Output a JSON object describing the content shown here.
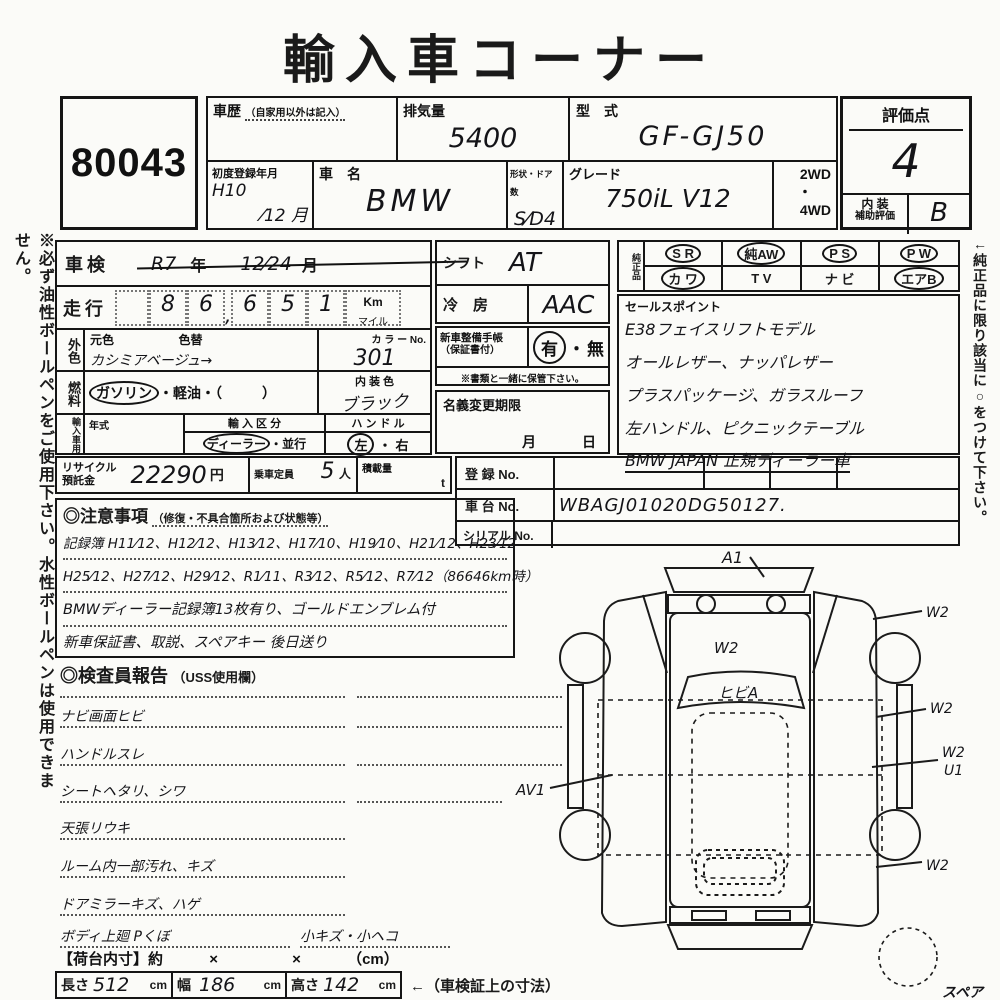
{
  "page": {
    "title": "輸入車コーナー"
  },
  "margins": {
    "left_note": "※必ず油性ボールペンをご使用下さい。水性ボールペンは使用できません。",
    "right_note": "←純正品に限り該当に○をつけて下さい。"
  },
  "lot": {
    "number": "80043"
  },
  "header": {
    "history_label": "車歴",
    "history_sub": "（自家用以外は記入）",
    "history_value": "",
    "displacement_label": "排気量",
    "displacement_value": "5400",
    "model_code_label": "型　式",
    "model_code_value": "GF-GJ50",
    "first_reg_label": "初度登録年月",
    "first_reg_top": "H10",
    "first_reg_bottom": "⁄12 月",
    "car_name_label": "車　名",
    "car_name_value": "BMW",
    "body_doors_label": "形状・ドア数",
    "body_doors_value": "S⁄D4",
    "grade_label": "グレード",
    "grade_value": "750iL  V12",
    "drive_top": "2WD",
    "drive_dot": "・",
    "drive_bottom": "4WD"
  },
  "score": {
    "label": "評価点",
    "value": "4",
    "interior_label_1": "内 装",
    "interior_label_2": "補助評価",
    "interior_value": "B"
  },
  "inspection_expiry": {
    "label": "車検",
    "era": "R7",
    "year_unit": "年",
    "date": "12⁄24",
    "month_unit": "月"
  },
  "mileage": {
    "label": "走行",
    "d1": "8",
    "d2": "6",
    "comma": ",",
    "d3": "6",
    "d4": "5",
    "d5": "1",
    "unit_top": "Km",
    "unit_bottom": "マイル"
  },
  "exterior": {
    "side_label": "外色",
    "base_label": "元色",
    "repaint_label": "色替",
    "value": "カシミアベージュ→",
    "color_no_label": "カ ラ ー No.",
    "color_no_value": "301"
  },
  "fuel": {
    "side_label": "燃料",
    "opt_gasoline": "ガソリン",
    "sep1": "・",
    "opt_diesel": "軽油",
    "sep2": "・（",
    "paren_close": "）",
    "interior_color_label": "内 装 色",
    "interior_color_value": "ブラック"
  },
  "import_use": {
    "side_label": "輸入車用",
    "year_label": "年式",
    "year_value": "",
    "route_label": "輸 入 区 分",
    "route_opt1": "ディーラー",
    "route_sep": "・",
    "route_opt2": "並行",
    "handle_label": "ハ ン ド ル",
    "handle_opt1": "左",
    "handle_sep": "・",
    "handle_opt2": "右"
  },
  "shift": {
    "label": "シフト",
    "value": "AT"
  },
  "ac": {
    "label": "冷　房",
    "value": "AAC"
  },
  "service_book": {
    "label_1": "新車整備手帳",
    "label_2": "（保証書付）",
    "yes": "有",
    "mid_dot": "・",
    "no": "無",
    "note": "※書類と一緒に保管下さい。"
  },
  "name_change": {
    "label": "名義変更期限",
    "month": "月",
    "day": "日"
  },
  "genuine": {
    "side_label": "純正品",
    "row1": [
      {
        "label": "S R",
        "circled": true
      },
      {
        "label": "純AW",
        "circled": true
      },
      {
        "label": "P S",
        "circled": true
      },
      {
        "label": "P W",
        "circled": true
      }
    ],
    "row2": [
      {
        "label": "カ ワ",
        "circled": true
      },
      {
        "label": "T V",
        "circled": false
      },
      {
        "label": "ナ ビ",
        "circled": false
      },
      {
        "label": "エアB",
        "circled": true
      }
    ]
  },
  "sales_points": {
    "label": "セールスポイント",
    "lines": [
      "E38フェイスリフトモデル",
      "オールレザー、ナッパレザー",
      "プラスパッケージ、ガラスルーフ",
      "左ハンドル、ピクニックテーブル",
      "BMW JAPAN 正規ディーラー車"
    ]
  },
  "recycle": {
    "label_1": "リサイクル",
    "label_2": "預託金",
    "value": "22290",
    "unit": "円"
  },
  "capacity": {
    "label": "乗車定員",
    "value": "5",
    "unit": "人"
  },
  "load": {
    "label": "積載量",
    "unit": "t"
  },
  "registration": {
    "reg_label": "登 録 No.",
    "reg_value": "",
    "chassis_label": "車 台 No.",
    "chassis_value": "WBAGJ01020DG50127.",
    "serial_label": "シリアル No.",
    "serial_value": ""
  },
  "cautions": {
    "title": "◎注意事項",
    "subtitle": "（修復・不具合箇所および状態等）",
    "lines": [
      "記録簿 H11⁄12、H12⁄12、H13⁄12、H17⁄10、H19⁄10、H21⁄12、H23⁄12",
      "H25⁄12、H27⁄12、H29⁄12、R1⁄11、R3⁄12、R5⁄12、R7⁄12（86646km時）",
      "BMWディーラー記録簿13枚有り、ゴールドエンブレム付",
      "新車保証書、取説、スペアキー 後日送り"
    ]
  },
  "report": {
    "title": "◎検査員報告",
    "subtitle": "（USS使用欄）",
    "lines": [
      "ナビ画面ヒビ",
      "ハンドルスレ",
      "シートヘタリ、シワ",
      "天張リウキ",
      "ルーム内一部汚れ、キズ",
      "ドアミラーキズ、ハゲ",
      "ボディ上廻 Pくぼ"
    ],
    "last_right": "小キズ・小ヘコ"
  },
  "cargo": {
    "label": "【荷台内寸】約",
    "times1": "×",
    "times2": "×",
    "unit": "（cm）"
  },
  "dimensions": {
    "length_label": "長さ",
    "length_value": "512",
    "length_unit": "cm",
    "width_label": "幅",
    "width_value": "186",
    "width_unit": "cm",
    "height_label": "高さ",
    "height_value": "142",
    "height_unit": "cm",
    "arrow_note": "←（車検証上の寸法）"
  },
  "diagram": {
    "front": "A1",
    "hood": "W2",
    "windshield": "ヒビA",
    "left_door": "AV1",
    "right_1": "W2",
    "right_2": "W2",
    "right_3a": "W2",
    "right_3b": "U1",
    "right_4": "W2",
    "spare_label": "スペア"
  }
}
